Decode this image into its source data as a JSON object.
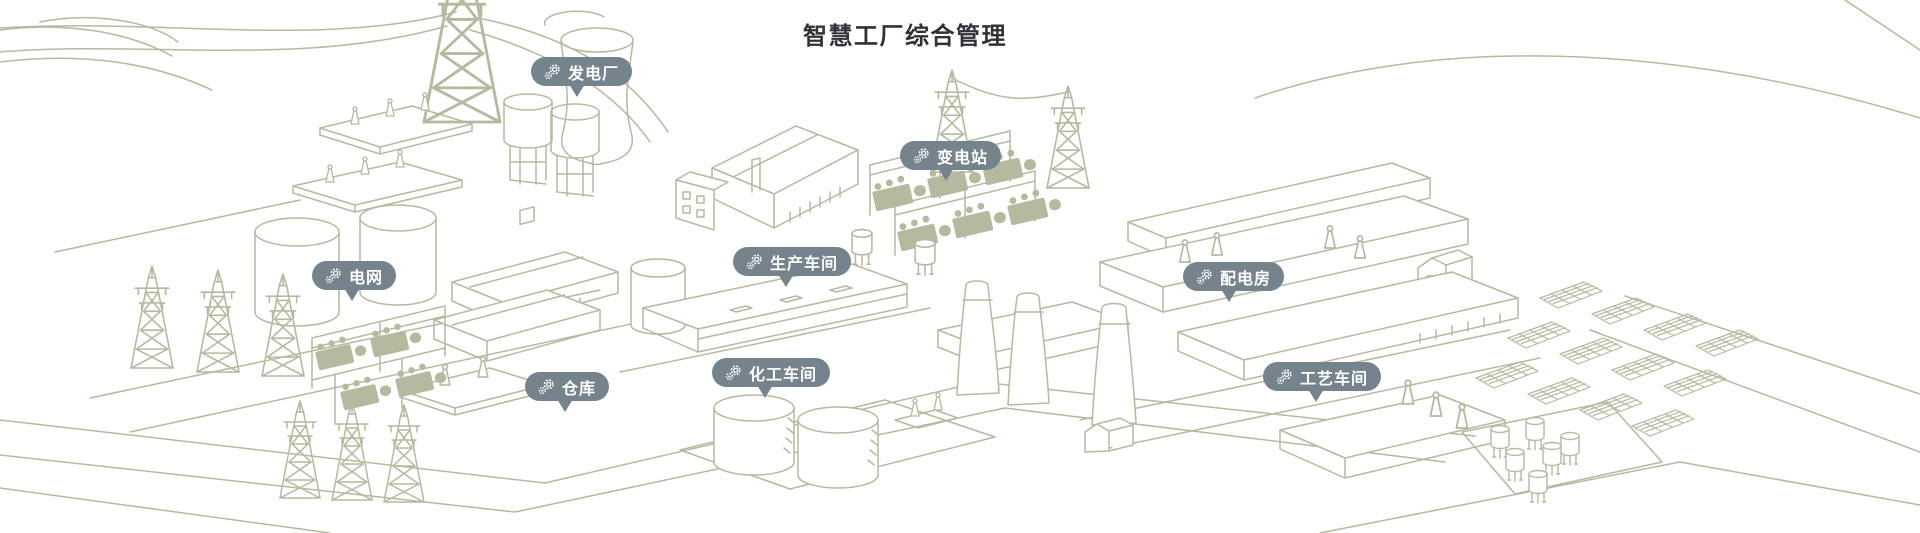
{
  "page": {
    "title": "智慧工厂综合管理"
  },
  "colors": {
    "background": "#ffffff",
    "title_color": "#2f3337",
    "badge_bg": "#75838d",
    "badge_text": "#ffffff",
    "line_art": "#b4ba9e"
  },
  "badges": [
    {
      "id": "power-plant",
      "label": "发电厂",
      "icon": "gears-icon"
    },
    {
      "id": "substation",
      "label": "变电站",
      "icon": "gears-icon"
    },
    {
      "id": "power-grid",
      "label": "电网",
      "icon": "gears-icon"
    },
    {
      "id": "production-workshop",
      "label": "生产车间",
      "icon": "gears-icon"
    },
    {
      "id": "distribution-room",
      "label": "配电房",
      "icon": "gears-icon"
    },
    {
      "id": "warehouse",
      "label": "仓库",
      "icon": "gears-icon"
    },
    {
      "id": "chemical-workshop",
      "label": "化工车间",
      "icon": "gears-icon"
    },
    {
      "id": "process-workshop",
      "label": "工艺车间",
      "icon": "gears-icon"
    }
  ],
  "illustration": {
    "style": "isometric-line-art",
    "elements": [
      "transmission-tower",
      "power-pylon",
      "cooling-tower",
      "silo-hopper",
      "storage-tank",
      "warehouse-shed",
      "factory-hall",
      "transformer-bank",
      "gantry-frame",
      "long-workshop",
      "chimney",
      "solar-panel-array",
      "small-tank",
      "road-network"
    ]
  }
}
